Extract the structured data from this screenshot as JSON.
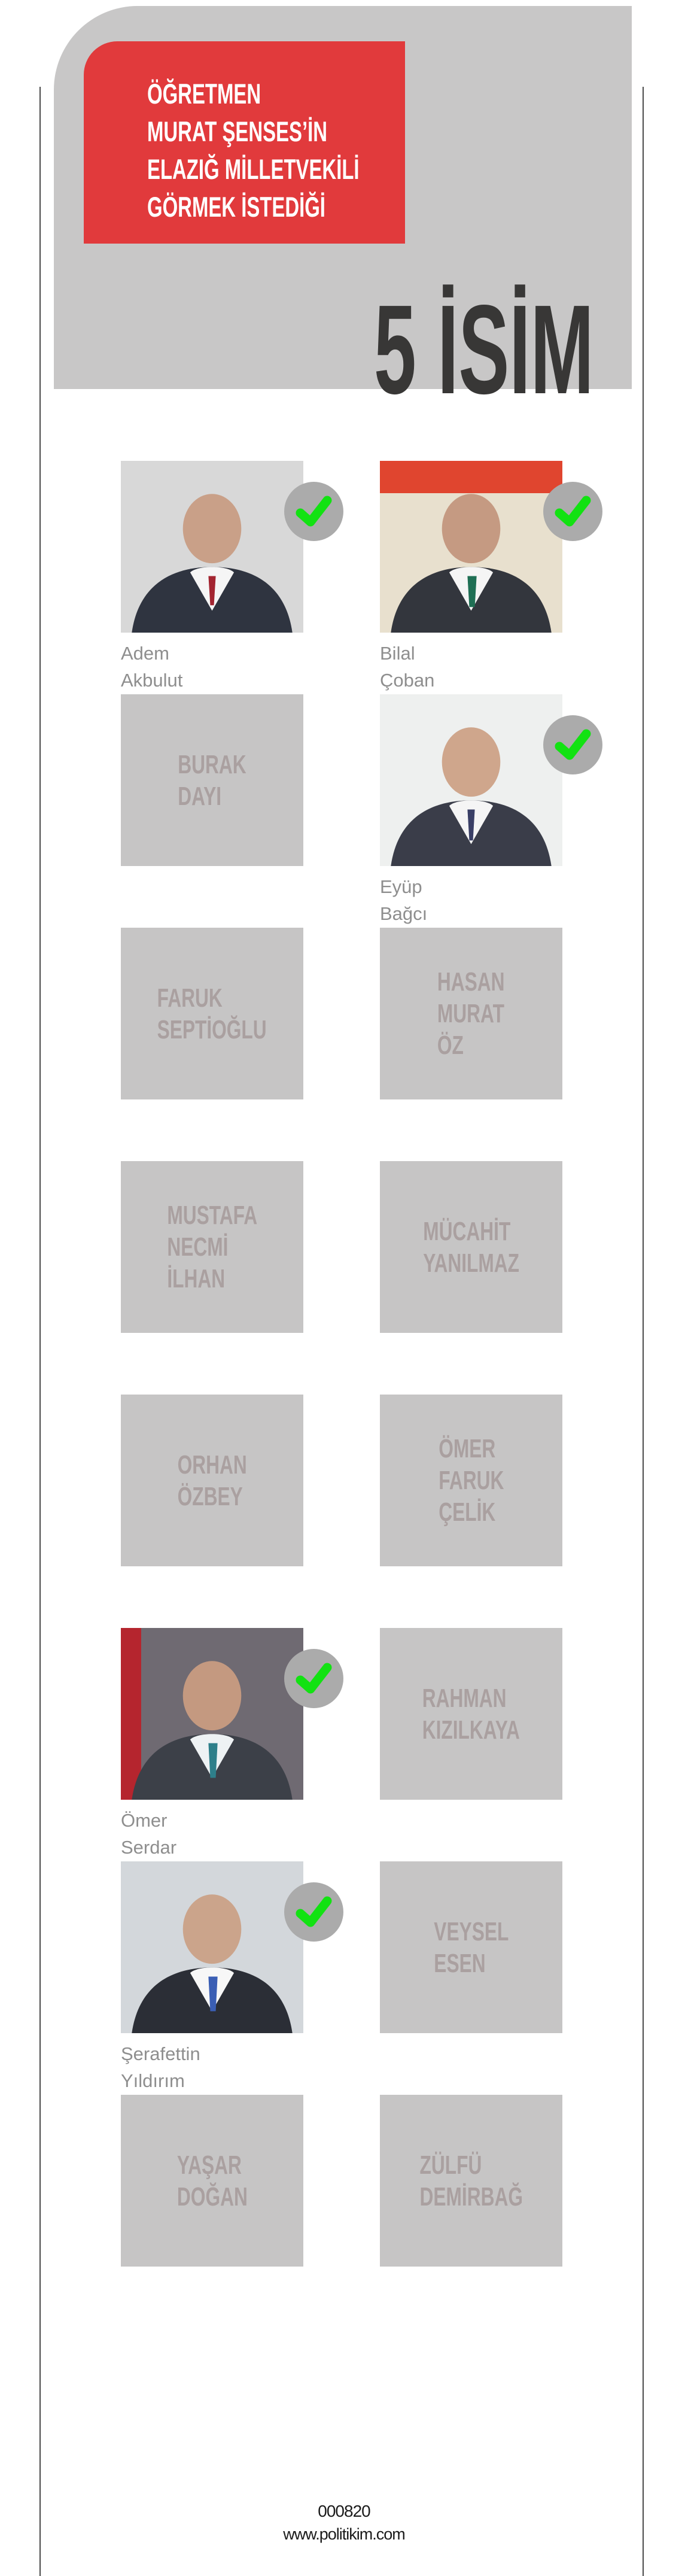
{
  "header": {
    "title_lines": [
      "ÖĞRETMEN",
      "MURAT ŞENSES’İN",
      "ELAZIĞ MİLLETVEKİLİ",
      "GÖRMEK İSTEDİĞİ"
    ],
    "count_title": "5 İSİM"
  },
  "colors": {
    "accent_red": "#e13a3c",
    "header_gray": "#c8c7c7",
    "placeholder_gray": "#c6c5c5",
    "placeholder_text": "#aaa0a0",
    "caption_gray": "#8e8e8e",
    "check_green": "#12e212",
    "check_circle_gray": "#ababab",
    "count_text": "#383736"
  },
  "candidates": [
    {
      "first": "Adem",
      "last": "Akbulut",
      "type": "photo",
      "checked": true
    },
    {
      "first": "Bilal",
      "last": "Çoban",
      "type": "photo",
      "checked": true
    },
    {
      "type": "placeholder",
      "lines": [
        "BURAK",
        "DAYI"
      ]
    },
    {
      "first": "Eyüp",
      "last": "Bağcı",
      "type": "photo",
      "checked": true
    },
    {
      "type": "placeholder",
      "lines": [
        "FARUK",
        "SEPTİOĞLU"
      ]
    },
    {
      "type": "placeholder",
      "lines": [
        "HASAN",
        "MURAT",
        "ÖZ"
      ]
    },
    {
      "type": "placeholder",
      "lines": [
        "MUSTAFA",
        "NECMİ",
        "İLHAN"
      ]
    },
    {
      "type": "placeholder",
      "lines": [
        "MÜCAHİT",
        "YANILMAZ"
      ]
    },
    {
      "type": "placeholder",
      "lines": [
        "ORHAN",
        "ÖZBEY"
      ]
    },
    {
      "type": "placeholder",
      "lines": [
        "ÖMER",
        "FARUK",
        "ÇELİK"
      ]
    },
    {
      "first": "Ömer",
      "last": "Serdar",
      "type": "photo",
      "checked": true
    },
    {
      "type": "placeholder",
      "lines": [
        "RAHMAN",
        "KIZILKAYA"
      ]
    },
    {
      "first": "Şerafettin",
      "last": "Yıldırım",
      "type": "photo",
      "checked": true
    },
    {
      "type": "placeholder",
      "lines": [
        "VEYSEL",
        "ESEN"
      ]
    },
    {
      "type": "placeholder",
      "lines": [
        "YAŞAR",
        "DOĞAN"
      ]
    },
    {
      "type": "placeholder",
      "lines": [
        "ZÜLFÜ",
        "DEMİRBAĞ"
      ]
    }
  ],
  "footer": {
    "code": "000820",
    "website": "www.politikim.com"
  }
}
